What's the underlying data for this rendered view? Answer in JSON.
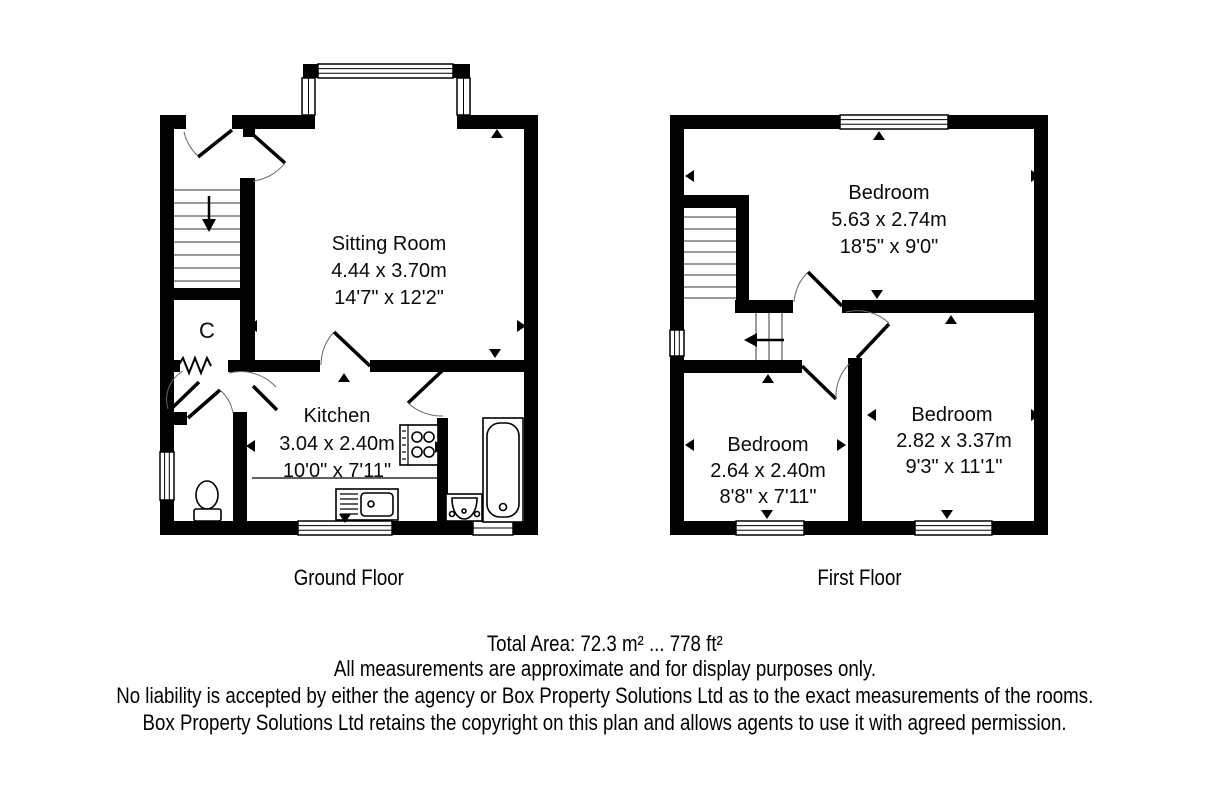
{
  "ground_floor": {
    "label": "Ground Floor",
    "rooms": {
      "sitting_room": {
        "name": "Sitting Room",
        "metric": "4.44 x 3.70m",
        "imperial": "14'7\" x 12'2\""
      },
      "kitchen": {
        "name": "Kitchen",
        "metric": "3.04 x 2.40m",
        "imperial": "10'0\" x 7'11\""
      },
      "cupboard": {
        "name": "C"
      }
    }
  },
  "first_floor": {
    "label": "First Floor",
    "rooms": {
      "bedroom_front": {
        "name": "Bedroom",
        "metric": "5.63 x 2.74m",
        "imperial": "18'5\" x 9'0\""
      },
      "bedroom_back_left": {
        "name": "Bedroom",
        "metric": "2.64 x 2.40m",
        "imperial": "8'8\" x 7'11\""
      },
      "bedroom_back_right": {
        "name": "Bedroom",
        "metric": "2.82 x 3.37m",
        "imperial": "9'3\" x 11'1\""
      }
    }
  },
  "footer": {
    "total_area": "Total Area: 72.3 m² ... 778 ft²",
    "line2": "All measurements are approximate and for display purposes only.",
    "line3": "No liability is accepted by either the agency or Box Property Solutions Ltd as to the exact measurements of the rooms.",
    "line4": "Box Property Solutions Ltd retains the copyright on this plan and allows agents to use it with agreed permission."
  },
  "colors": {
    "wall": "#000000",
    "background": "#ffffff",
    "tread": "#7a7a7a"
  }
}
